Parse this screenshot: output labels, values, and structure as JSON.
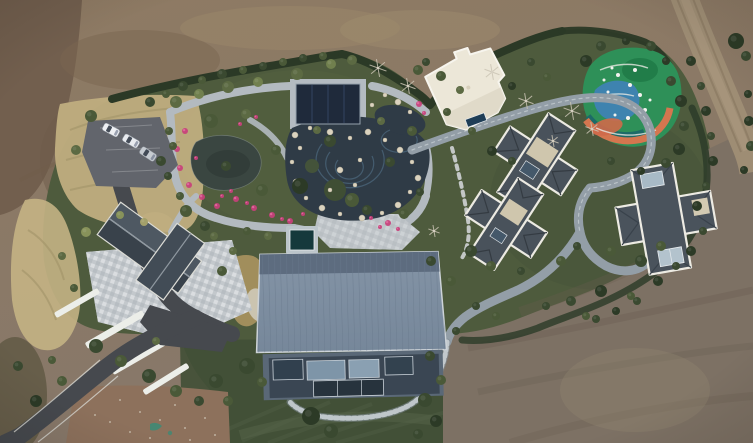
{
  "meta": {
    "title": "Aerial drone photograph of a landscaped private estate: central garden with ponds and winding stone paths, large blue-metal-roof barn house, three slate-roof villas, white flat-roof pavilion, colorful children's playground, parking area with cars, asphalt driveway, all surrounded by bare brown earthworks",
    "type": "aerial-photograph",
    "width_px": 753,
    "height_px": 443
  },
  "palette": {
    "dirt_top": "#8e7a63",
    "dirt_bottom": "#87786a",
    "dirt_dark": "#6f5c4b",
    "dirt_gray": "#7d7164",
    "dirt_pink": "#8d715c",
    "dirt_road": "#9e8d74",
    "grass_green": "#4e5b3d",
    "lawn_dark": "#414f36",
    "dry_grass": "#c0ae7f",
    "hedge": "#2b3926",
    "pond_dark": "#2f3b46",
    "pond_left": "#3a4641",
    "stone_path": "#b3bac0",
    "winding_road": "#939ea7",
    "asphalt": "#46494e",
    "parking": "#62656c",
    "barn_roof": "#7e8ea1",
    "barn_roof_band": "#5d6c7f",
    "villa_roof": "#49525b",
    "villa_trim": "#eceae2",
    "white_building": "#ece7d8",
    "pavilion_navy": "#1f2a3b",
    "pool_teal": "#15393c",
    "flower_pink": "#c8407b",
    "flower_pink_light": "#e06a9e",
    "rock": "#dbd3bf",
    "playground_green": "#2e9058",
    "playground_blue": "#3f83b4",
    "playground_orange": "#d4764f",
    "playground_teal": "#1d6a68",
    "car_white": "#eef0f3",
    "wall_white": "#eceee9"
  },
  "scene": {
    "regions": [
      {
        "name": "bare-earth-surround",
        "desc": "graded brown dirt surrounding the estate on all sides with vehicle tracks"
      },
      {
        "name": "estate-garden",
        "desc": "irregular green landscaped compound with hedged boundary"
      },
      {
        "name": "rock-garden-ponds",
        "desc": "central ornamental garden with two dark ponds, white boulders and looping stone paths"
      },
      {
        "name": "dry-grass-bank",
        "desc": "tan ornamental grass slope around the parking area and driveway"
      },
      {
        "name": "bottom-lawn",
        "desc": "mown lawn below the barn house with curved lighter path"
      },
      {
        "name": "dirt-access-road",
        "desc": "unpaved track crossing the top-right corner"
      }
    ],
    "buildings": [
      {
        "name": "gatehouse",
        "desc": "dark gabled roof over checkered stone plaza, lower left"
      },
      {
        "name": "barn-house",
        "desc": "large blue-gray standing-seam metal roof with glass facade, center bottom"
      },
      {
        "name": "villa-upper",
        "desc": "cross-plan dark slate hip roof with white trim"
      },
      {
        "name": "villa-lower",
        "desc": "cross-plan dark slate hip roof with white trim"
      },
      {
        "name": "villa-right",
        "desc": "cross-plan slate roof with skylights, right side"
      },
      {
        "name": "white-pavilion",
        "desc": "cream flat-roof building, top center-right"
      },
      {
        "name": "garden-pavilion",
        "desc": "navy-roofed pool pavilion in the garden"
      }
    ],
    "tree_colors": [
      "#2c3a26",
      "#3a4930",
      "#4a5938",
      "#5c6a43",
      "#71804e",
      "#87925a",
      "#a3a06a"
    ],
    "trees": [
      [
        150,
        102,
        5,
        1
      ],
      [
        166,
        94,
        4,
        2
      ],
      [
        183,
        86,
        5,
        1
      ],
      [
        202,
        80,
        4,
        2
      ],
      [
        222,
        74,
        5,
        1
      ],
      [
        243,
        70,
        4,
        2
      ],
      [
        263,
        66,
        4,
        1
      ],
      [
        283,
        62,
        4,
        2
      ],
      [
        303,
        58,
        4,
        1
      ],
      [
        323,
        56,
        4,
        2
      ],
      [
        176,
        102,
        6,
        3
      ],
      [
        199,
        94,
        5,
        4
      ],
      [
        228,
        87,
        6,
        3
      ],
      [
        258,
        82,
        5,
        4
      ],
      [
        297,
        74,
        6,
        3
      ],
      [
        331,
        64,
        5,
        4
      ],
      [
        352,
        60,
        5,
        3
      ],
      [
        211,
        121,
        7,
        2
      ],
      [
        246,
        114,
        5,
        3
      ],
      [
        330,
        141,
        6,
        1
      ],
      [
        300,
        186,
        8,
        0
      ],
      [
        262,
        190,
        6,
        2
      ],
      [
        226,
        166,
        5,
        1
      ],
      [
        352,
        200,
        7,
        2
      ],
      [
        390,
        162,
        5,
        1
      ],
      [
        412,
        131,
        5,
        2
      ],
      [
        381,
        121,
        4,
        3
      ],
      [
        276,
        150,
        5,
        2
      ],
      [
        317,
        130,
        4,
        3
      ],
      [
        367,
        210,
        5,
        1
      ],
      [
        404,
        214,
        5,
        2
      ],
      [
        420,
        192,
        4,
        1
      ],
      [
        91,
        116,
        6,
        2
      ],
      [
        76,
        150,
        5,
        3
      ],
      [
        169,
        131,
        4,
        2
      ],
      [
        161,
        161,
        5,
        1
      ],
      [
        186,
        211,
        6,
        2
      ],
      [
        205,
        226,
        5,
        1
      ],
      [
        144,
        222,
        4,
        6
      ],
      [
        120,
        215,
        4,
        5
      ],
      [
        86,
        232,
        5,
        5
      ],
      [
        62,
        256,
        4,
        3
      ],
      [
        222,
        271,
        5,
        2
      ],
      [
        233,
        251,
        4,
        3
      ],
      [
        74,
        288,
        4,
        2
      ],
      [
        96,
        346,
        7,
        1
      ],
      [
        121,
        361,
        6,
        2
      ],
      [
        149,
        376,
        7,
        1
      ],
      [
        176,
        391,
        6,
        2
      ],
      [
        199,
        401,
        5,
        1
      ],
      [
        156,
        341,
        4,
        3
      ],
      [
        62,
        381,
        5,
        2
      ],
      [
        36,
        401,
        6,
        0
      ],
      [
        216,
        381,
        7,
        1
      ],
      [
        228,
        401,
        5,
        2
      ],
      [
        18,
        366,
        5,
        1
      ],
      [
        52,
        360,
        4,
        2
      ],
      [
        311,
        416,
        9,
        0
      ],
      [
        331,
        431,
        7,
        1
      ],
      [
        247,
        366,
        8,
        1
      ],
      [
        262,
        382,
        5,
        2
      ],
      [
        425,
        400,
        7,
        1
      ],
      [
        436,
        421,
        6,
        0
      ],
      [
        418,
        434,
        5,
        1
      ],
      [
        441,
        380,
        5,
        2
      ],
      [
        430,
        356,
        5,
        1
      ],
      [
        441,
        76,
        5,
        2
      ],
      [
        426,
        62,
        4,
        1
      ],
      [
        447,
        112,
        4,
        2
      ],
      [
        512,
        86,
        4,
        0
      ],
      [
        531,
        62,
        4,
        1
      ],
      [
        547,
        77,
        4,
        2
      ],
      [
        472,
        131,
        4,
        2
      ],
      [
        492,
        151,
        5,
        0
      ],
      [
        512,
        161,
        4,
        1
      ],
      [
        460,
        90,
        4,
        3
      ],
      [
        418,
        70,
        5,
        2
      ],
      [
        471,
        251,
        6,
        1
      ],
      [
        491,
        266,
        5,
        2
      ],
      [
        521,
        271,
        4,
        1
      ],
      [
        451,
        281,
        5,
        2
      ],
      [
        431,
        261,
        5,
        1
      ],
      [
        561,
        261,
        5,
        2
      ],
      [
        577,
        246,
        4,
        1
      ],
      [
        611,
        251,
        5,
        2
      ],
      [
        641,
        261,
        6,
        1
      ],
      [
        661,
        246,
        5,
        2
      ],
      [
        601,
        291,
        6,
        0
      ],
      [
        571,
        301,
        5,
        1
      ],
      [
        631,
        296,
        4,
        2
      ],
      [
        546,
        306,
        4,
        1
      ],
      [
        586,
        316,
        4,
        2
      ],
      [
        476,
        306,
        4,
        1
      ],
      [
        496,
        316,
        4,
        2
      ],
      [
        456,
        331,
        4,
        1
      ],
      [
        586,
        61,
        6,
        0
      ],
      [
        601,
        46,
        5,
        1
      ],
      [
        626,
        41,
        4,
        0
      ],
      [
        651,
        46,
        5,
        1
      ],
      [
        666,
        61,
        4,
        0
      ],
      [
        671,
        81,
        5,
        1
      ],
      [
        681,
        101,
        6,
        0
      ],
      [
        684,
        126,
        5,
        1
      ],
      [
        679,
        149,
        6,
        0
      ],
      [
        666,
        163,
        5,
        1
      ],
      [
        641,
        171,
        4,
        0
      ],
      [
        611,
        161,
        4,
        1
      ],
      [
        691,
        61,
        5,
        0
      ],
      [
        701,
        86,
        4,
        1
      ],
      [
        706,
        111,
        5,
        0
      ],
      [
        711,
        136,
        4,
        1
      ],
      [
        713,
        161,
        5,
        0
      ],
      [
        706,
        186,
        4,
        1
      ],
      [
        697,
        206,
        5,
        0
      ],
      [
        703,
        231,
        4,
        1
      ],
      [
        691,
        251,
        5,
        0
      ],
      [
        676,
        266,
        4,
        1
      ],
      [
        658,
        281,
        5,
        0
      ],
      [
        637,
        301,
        4,
        1
      ],
      [
        616,
        311,
        4,
        0
      ],
      [
        596,
        319,
        4,
        1
      ],
      [
        736,
        41,
        8,
        0
      ],
      [
        746,
        56,
        5,
        1
      ],
      [
        748,
        94,
        4,
        0
      ],
      [
        749,
        121,
        5,
        0
      ],
      [
        751,
        146,
        5,
        1
      ],
      [
        744,
        170,
        4,
        0
      ],
      [
        173,
        146,
        4,
        2
      ],
      [
        168,
        176,
        4,
        1
      ],
      [
        180,
        196,
        4,
        2
      ],
      [
        214,
        236,
        4,
        3
      ],
      [
        247,
        231,
        4,
        2
      ],
      [
        268,
        236,
        4,
        3
      ]
    ],
    "bare_trees": [
      [
        378,
        68,
        9
      ],
      [
        408,
        86,
        8
      ],
      [
        492,
        72,
        8
      ],
      [
        526,
        101,
        8
      ],
      [
        572,
        111,
        9
      ],
      [
        592,
        129,
        7
      ],
      [
        434,
        231,
        6
      ],
      [
        553,
        141,
        6
      ]
    ],
    "flowers": [
      [
        185,
        131,
        3
      ],
      [
        177,
        149,
        3
      ],
      [
        180,
        168,
        3
      ],
      [
        189,
        185,
        3
      ],
      [
        202,
        197,
        3
      ],
      [
        217,
        206,
        3
      ],
      [
        236,
        199,
        3
      ],
      [
        254,
        208,
        3
      ],
      [
        272,
        215,
        3
      ],
      [
        290,
        221,
        3
      ],
      [
        303,
        214,
        2
      ],
      [
        240,
        124,
        2
      ],
      [
        256,
        117,
        2
      ],
      [
        222,
        196,
        2
      ],
      [
        231,
        191,
        2
      ],
      [
        388,
        223,
        3
      ],
      [
        398,
        229,
        2
      ],
      [
        371,
        218,
        2
      ],
      [
        419,
        104,
        3
      ],
      [
        424,
        113,
        2
      ],
      [
        380,
        227,
        2
      ],
      [
        196,
        158,
        2
      ],
      [
        247,
        203,
        2
      ],
      [
        282,
        219,
        2
      ]
    ],
    "rocks": [
      [
        295,
        135,
        3
      ],
      [
        310,
        128,
        2
      ],
      [
        330,
        132,
        3
      ],
      [
        350,
        138,
        2
      ],
      [
        368,
        132,
        3
      ],
      [
        385,
        140,
        2
      ],
      [
        400,
        150,
        3
      ],
      [
        412,
        162,
        2
      ],
      [
        418,
        178,
        3
      ],
      [
        410,
        192,
        2
      ],
      [
        398,
        205,
        3
      ],
      [
        382,
        213,
        2
      ],
      [
        362,
        218,
        3
      ],
      [
        340,
        214,
        2
      ],
      [
        322,
        208,
        3
      ],
      [
        306,
        198,
        2
      ],
      [
        296,
        182,
        3
      ],
      [
        292,
        162,
        2
      ],
      [
        300,
        148,
        2
      ],
      [
        340,
        170,
        3
      ],
      [
        355,
        185,
        2
      ],
      [
        330,
        190,
        2
      ],
      [
        360,
        160,
        2
      ],
      [
        385,
        95,
        2
      ],
      [
        398,
        102,
        3
      ],
      [
        410,
        112,
        2
      ],
      [
        372,
        105,
        2
      ]
    ],
    "play_equipment": [
      [
        618,
        75,
        2
      ],
      [
        630,
        85,
        2
      ],
      [
        640,
        95,
        2
      ],
      [
        622,
        100,
        1.5
      ],
      [
        608,
        92,
        1.5
      ],
      [
        635,
        70,
        2
      ],
      [
        645,
        110,
        2
      ],
      [
        615,
        115,
        1.5
      ],
      [
        604,
        80,
        1.5
      ],
      [
        628,
        118,
        2
      ],
      [
        650,
        100,
        1.5
      ],
      [
        612,
        68,
        1.5
      ]
    ],
    "debris": [
      [
        120,
        400
      ],
      [
        140,
        412
      ],
      [
        160,
        420
      ],
      [
        185,
        428
      ],
      [
        205,
        418
      ],
      [
        130,
        432
      ],
      [
        175,
        405
      ],
      [
        95,
        415
      ],
      [
        150,
        438
      ],
      [
        215,
        435
      ],
      [
        110,
        422
      ],
      [
        190,
        440
      ]
    ],
    "terrace_walls": [
      [
        52,
        300,
        50,
        6,
        -30
      ],
      [
        82,
        326,
        66,
        7,
        -30
      ],
      [
        108,
        352,
        66,
        7,
        -30
      ],
      [
        140,
        376,
        52,
        6,
        -32
      ]
    ],
    "mow_stripes": [
      [
        242,
        441,
        330,
        402
      ],
      [
        268,
        443,
        372,
        404
      ],
      [
        300,
        443,
        412,
        406
      ],
      [
        336,
        443,
        446,
        412
      ],
      [
        226,
        430,
        300,
        398
      ]
    ],
    "vehicles": {
      "cars": [
        {
          "x": 111,
          "y": 130,
          "a": 28,
          "body": "#eef0f3"
        },
        {
          "x": 131,
          "y": 141,
          "a": 30,
          "body": "#e8ebef"
        },
        {
          "x": 148,
          "y": 154,
          "a": 33,
          "body": "#c6cbd1"
        }
      ]
    }
  }
}
